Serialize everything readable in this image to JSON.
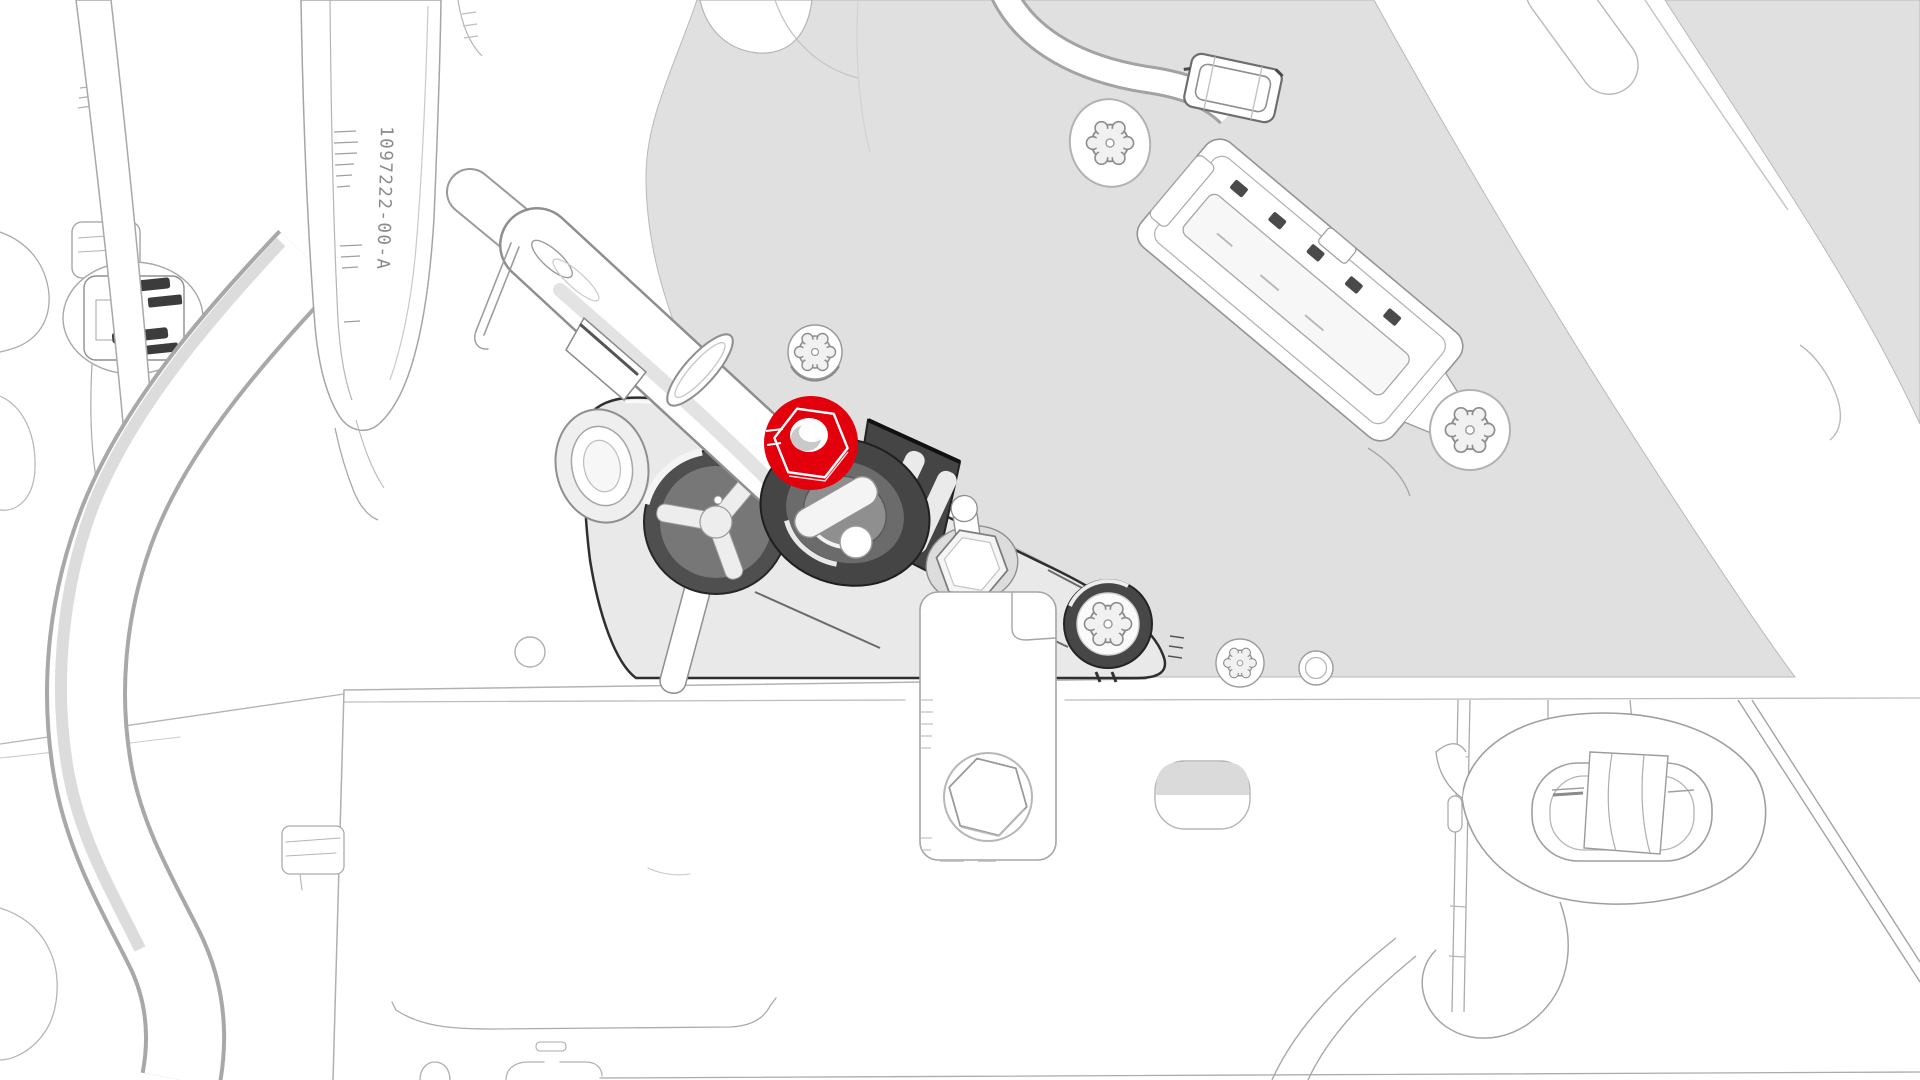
{
  "illustration": {
    "type": "service-manual-technical-illustration",
    "background_color": "#ffffff",
    "panel_color": "#e0e0e0",
    "bracket_color": "#e9e9e9",
    "line_color": "#8f8f8f",
    "dark_detail_color": "#3f3f3f",
    "highlight_color": "#e2000d",
    "part_label": {
      "text": "1097222-00-A",
      "rotation_deg": 91.5,
      "color": "#8a8a8a"
    },
    "highlighted_part": "hex-flange-nut",
    "parts": [
      "body-panel",
      "label-strap",
      "corrugated-hose",
      "harness-band",
      "wire-clip-connector",
      "steering-column-shaft",
      "column-collar",
      "mounting-bracket",
      "hex-flange-nut-highlighted",
      "ball-stud",
      "hex-standoff",
      "torx-bolt-top",
      "torx-bolt-right",
      "torx-bolt-free",
      "torx-screw-bracket",
      "cable-clamp",
      "electrical-connector",
      "frame-crossmember",
      "hanging-bracket-plate",
      "hex-head-bolt",
      "oval-slot",
      "rubber-grommet-mount"
    ]
  }
}
